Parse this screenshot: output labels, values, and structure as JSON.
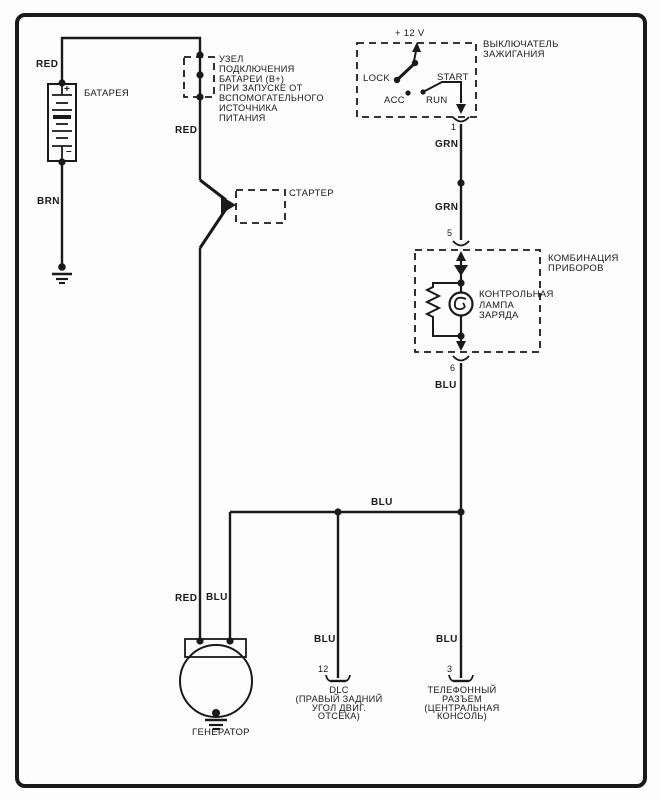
{
  "ink": "#1a1a1a",
  "battery": {
    "label": "БАТАРЕЯ",
    "plus": "+",
    "minus": "–",
    "wire_top": "RED",
    "wire_bottom": "BRN"
  },
  "jumper_note": "УЗЕЛ\nПОДКЛЮЧЕНИЯ\nБАТАРЕИ (B+)\nПРИ ЗАПУСКЕ ОТ\nВСПОМОГАТЕЛЬНОГО\nИСТОЧНИКА\nПИТАНИЯ",
  "starter": {
    "label": "СТАРТЕР"
  },
  "ignition": {
    "title": "ВЫКЛЮЧАТЕЛЬ\nЗАЖИГАНИЯ",
    "supply": "+ 12 V",
    "lock": "LOCK",
    "acc": "ACC",
    "run": "RUN",
    "start": "START",
    "pin": "1"
  },
  "wires": {
    "red_main": "RED",
    "red_gen": "RED",
    "grn_1": "GRN",
    "grn_2": "GRN",
    "blu_cluster": "BLU",
    "blu_bus": "BLU",
    "blu_gen": "BLU",
    "blu_dlc": "BLU",
    "blu_phone": "BLU"
  },
  "cluster": {
    "title": "КОМБИНАЦИЯ\nПРИБОРОВ",
    "lamp": "КОНТРОЛЬНАЯ\nЛАМПА\nЗАРЯДА",
    "pin_in": "5",
    "pin_out": "6"
  },
  "generator": {
    "label": "ГЕНЕРАТОР"
  },
  "dlc": {
    "pin": "12",
    "label": "DLC\n(ПРАВЫЙ ЗАДНИЙ\nУГОЛ ДВИГ.\nОТСЕКА)"
  },
  "phone": {
    "pin": "3",
    "label": "ТЕЛЕФОННЫЙ\nРАЗЪЕМ\n(ЦЕНТРАЛЬНАЯ\nКОНСОЛЬ)"
  }
}
